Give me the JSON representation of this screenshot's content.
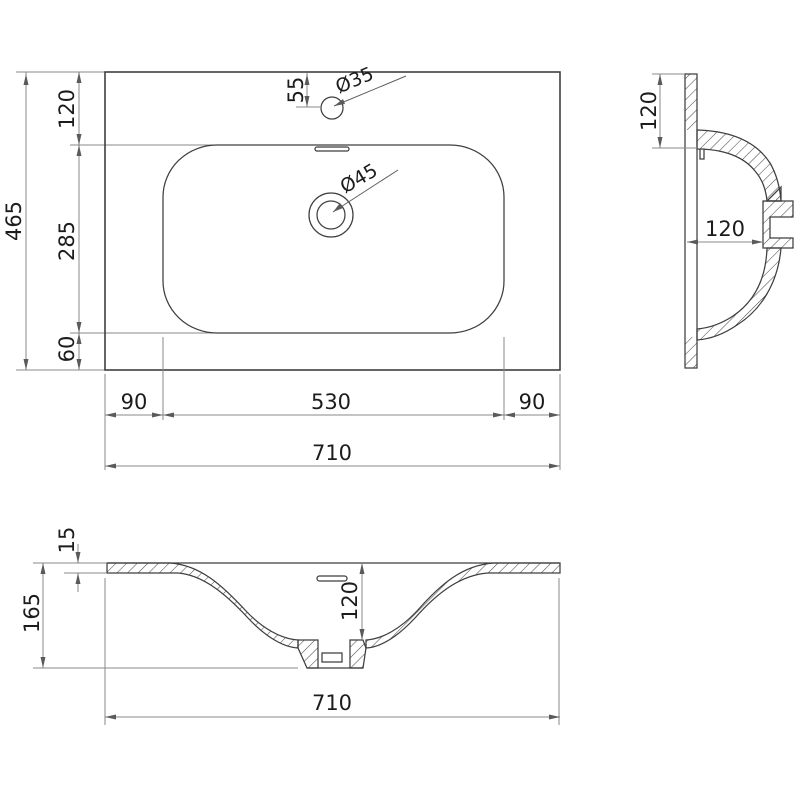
{
  "title": "Washbasin dimensional drawing",
  "colors": {
    "background": "#ffffff",
    "geometry_line": "#3f3f3f",
    "dimension_line": "#8a8a8a",
    "text": "#1c1c1c"
  },
  "top_view": {
    "name": "top view (plan)",
    "depth_total": "465",
    "depth_top": "120",
    "depth_basin": "285",
    "depth_bottom": "60",
    "faucet_offset": "55",
    "faucet_hole_diameter": "Ø35",
    "drain_hole_diameter": "Ø45",
    "width_left_margin": "90",
    "width_basin": "530",
    "width_right_margin": "90",
    "width_total": "710"
  },
  "side_view": {
    "name": "side section",
    "back_edge_to_basin": "120",
    "basin_depth": "120"
  },
  "front_view": {
    "name": "front section",
    "deck_thickness": "15",
    "height_total": "165",
    "basin_depth": "120",
    "width_total": "710"
  }
}
